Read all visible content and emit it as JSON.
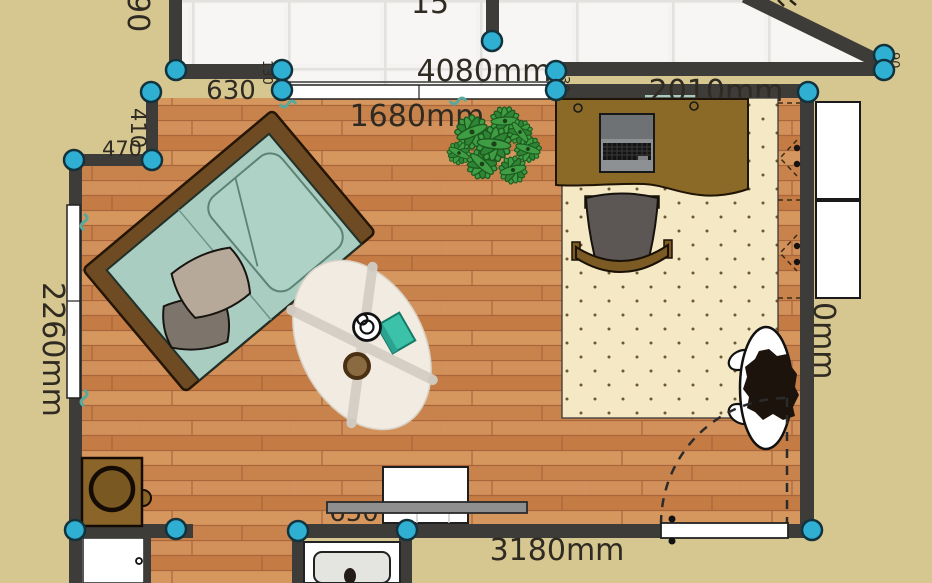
{
  "scene": {
    "type": "floor-plan-editor",
    "unit": "mm",
    "control_point_count": 17
  },
  "colors": {
    "background": "#d6c690",
    "wall": "#3e3c38",
    "floor_wood": "#cd8850",
    "tile_room": "#f4f3f1",
    "control_point": "#2fb0d2",
    "rug": "#f5e8c4",
    "desk": "#8a6a26",
    "sofa_mattress": "#a9cec1",
    "sofa_frame": "#6e4b22",
    "dimension_text": "#2f2a22",
    "shelf_bar": "#8f8f8f",
    "wall_accent": "#a9c9c1"
  },
  "dimensions": {
    "top_wall": "4080mm",
    "top_right_wall": "2010mm",
    "top_window": "1680mm",
    "seg_630": "630",
    "seg_470": "470",
    "seg_410": "410",
    "left_wall": "2260mm",
    "bottom_wall": "3180mm",
    "shelf": "650",
    "right_wall_clipped": "0mm",
    "top_left_clipped": "90",
    "window_offset_left": "130",
    "window_offset_right": "30",
    "corner_offset_right": "90",
    "top_center_clipped": "15"
  },
  "furniture": [
    "sofa-daybed",
    "coffee-table",
    "cup",
    "book",
    "bowl",
    "plant",
    "desk",
    "laptop",
    "rocking-desk-chair",
    "rug",
    "person",
    "washing-machine",
    "sideboard",
    "wall-shelf",
    "shower",
    "entrance-door",
    "wardrobe-markings",
    "outside-cabinets"
  ]
}
